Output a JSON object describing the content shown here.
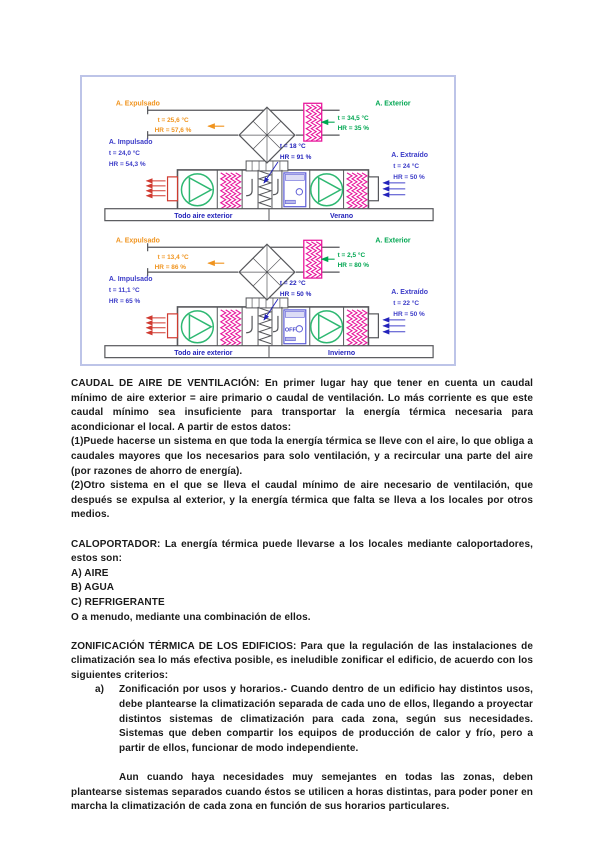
{
  "figure": {
    "colors": {
      "orange": "#f0941f",
      "green": "#00a651",
      "indigo": "#3c3cc8",
      "blue": "#2323bb",
      "magenta": "#e8189c",
      "fan_green": "#2eb872",
      "red": "#d03a30",
      "outline": "#55565a",
      "border": "#bdc4e8"
    },
    "units": {
      "verano": {
        "expulsado_title": "A. Expulsado",
        "expulsado_t": "t = 25,6 °C",
        "expulsado_hr": "HR = 57,6 %",
        "exterior_title": "A. Exterior",
        "exterior_t": "t = 34,5 °C",
        "exterior_hr": "HR = 35 %",
        "impulsado_title": "A. Impulsado",
        "impulsado_t": "t = 24,0 °C",
        "impulsado_hr": "HR = 54,3 %",
        "extraido_title": "A. Extraído",
        "extraido_t": "t = 24 °C",
        "extraido_hr": "HR = 50 %",
        "center_t": "t = 18 °C",
        "center_hr": "HR = 91 %",
        "box_label": "",
        "bar_left": "Todo aire exterior",
        "bar_right": "Verano"
      },
      "invierno": {
        "expulsado_title": "A. Expulsado",
        "expulsado_t": "t = 13,4 °C",
        "expulsado_hr": "HR = 86 %",
        "exterior_title": "A. Exterior",
        "exterior_t": "t = 2,5 °C",
        "exterior_hr": "HR = 80 %",
        "impulsado_title": "A. Impulsado",
        "impulsado_t": "t = 11,1 °C",
        "impulsado_hr": "HR = 65 %",
        "extraido_title": "A. Extraído",
        "extraido_t": "t = 22 °C",
        "extraido_hr": "HR = 50 %",
        "center_t": "t = 22 °C",
        "center_hr": "HR = 50 %",
        "box_label": "OFF",
        "bar_left": "Todo aire exterior",
        "bar_right": "Invierno"
      }
    }
  },
  "content": {
    "caudal": "CAUDAL DE AIRE DE VENTILACIÓN: En primer lugar hay que tener en cuenta un caudal mínimo de aire exterior = aire primario o caudal de ventilación. Lo más corriente es que este caudal mínimo sea insuficiente para transportar la energía térmica necesaria para acondicionar el local. A partir de estos datos:",
    "item1": "(1)Puede hacerse un sistema en que toda la energía térmica se lleve con el aire, lo que obliga a caudales mayores que los necesarios para solo ventilación, y a recircular una parte del aire (por razones de ahorro de energía).",
    "item2": "(2)Otro sistema en el que se lleva el caudal mínimo de aire necesario de ventilación, que después se expulsa al exterior, y la energía térmica que falta se lleva a los locales por otros medios.",
    "calo": "CALOPORTADOR: La energía térmica puede llevarse a los locales mediante caloportadores, estos son:",
    "opt_a": "A) AIRE",
    "opt_b": "B) AGUA",
    "opt_c": "C) REFRIGERANTE",
    "combo": "O a menudo, mediante una combinación de ellos.",
    "zoni": "ZONIFICACIÓN TÉRMICA DE LOS EDIFICIOS: Para que la regulación de las instalaciones de climatización sea lo más efectiva posible, es ineludible zonificar el edificio, de acuerdo con los siguientes criterios:",
    "item_a_marker": "a)",
    "item_a": "Zonificación por usos y horarios.- Cuando dentro de un edificio hay distintos usos, debe plantearse la climatización separada de cada uno de ellos, llegando a proyectar distintos sistemas de climatización para cada zona, según sus necesidades. Sistemas que deben compartir los equipos de producción de calor y frío, pero a partir de ellos, funcionar de modo independiente.",
    "aun": "Aun cuando haya necesidades muy semejantes en todas las zonas, deben plantearse sistemas separados cuando éstos se utilicen a horas distintas, para poder poner en marcha la climatización de cada zona en función de sus horarios particulares."
  }
}
